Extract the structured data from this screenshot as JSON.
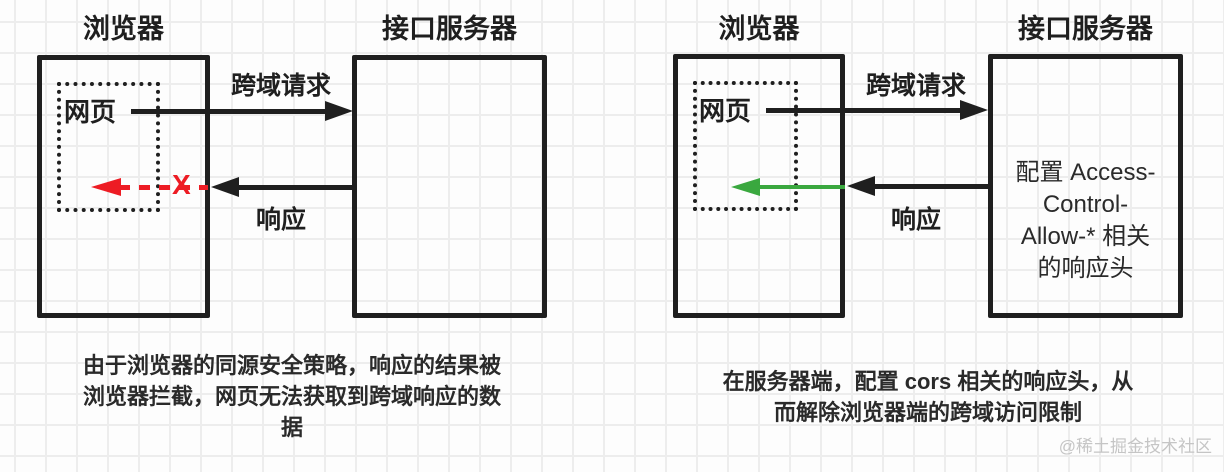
{
  "colors": {
    "ink": "#1f1f1f",
    "red": "#ed1c24",
    "green": "#3aa83f",
    "grid": "#ededed",
    "wm": "#c5c5c5",
    "text": "#2a2a2a"
  },
  "left_diagram": {
    "browser_title": "浏览器",
    "server_title": "接口服务器",
    "webpage_label": "网页",
    "request_label": "跨域请求",
    "response_label": "响应",
    "blocked_x": "X",
    "caption_lines": [
      "由于浏览器的同源安全策略，响应的结果被",
      "浏览器拦截，网页无法获取到跨域响应的数",
      "据"
    ]
  },
  "right_diagram": {
    "browser_title": "浏览器",
    "server_title": "接口服务器",
    "webpage_label": "网页",
    "request_label": "跨域请求",
    "response_label": "响应",
    "server_box_lines": [
      "配置 Access-",
      "Control-",
      "Allow-* 相关",
      "的响应头"
    ],
    "caption_lines": [
      "在服务器端，配置 cors 相关的响应头，从",
      "而解除浏览器端的跨域访问限制"
    ]
  },
  "watermark": "@稀土掘金技术社区"
}
